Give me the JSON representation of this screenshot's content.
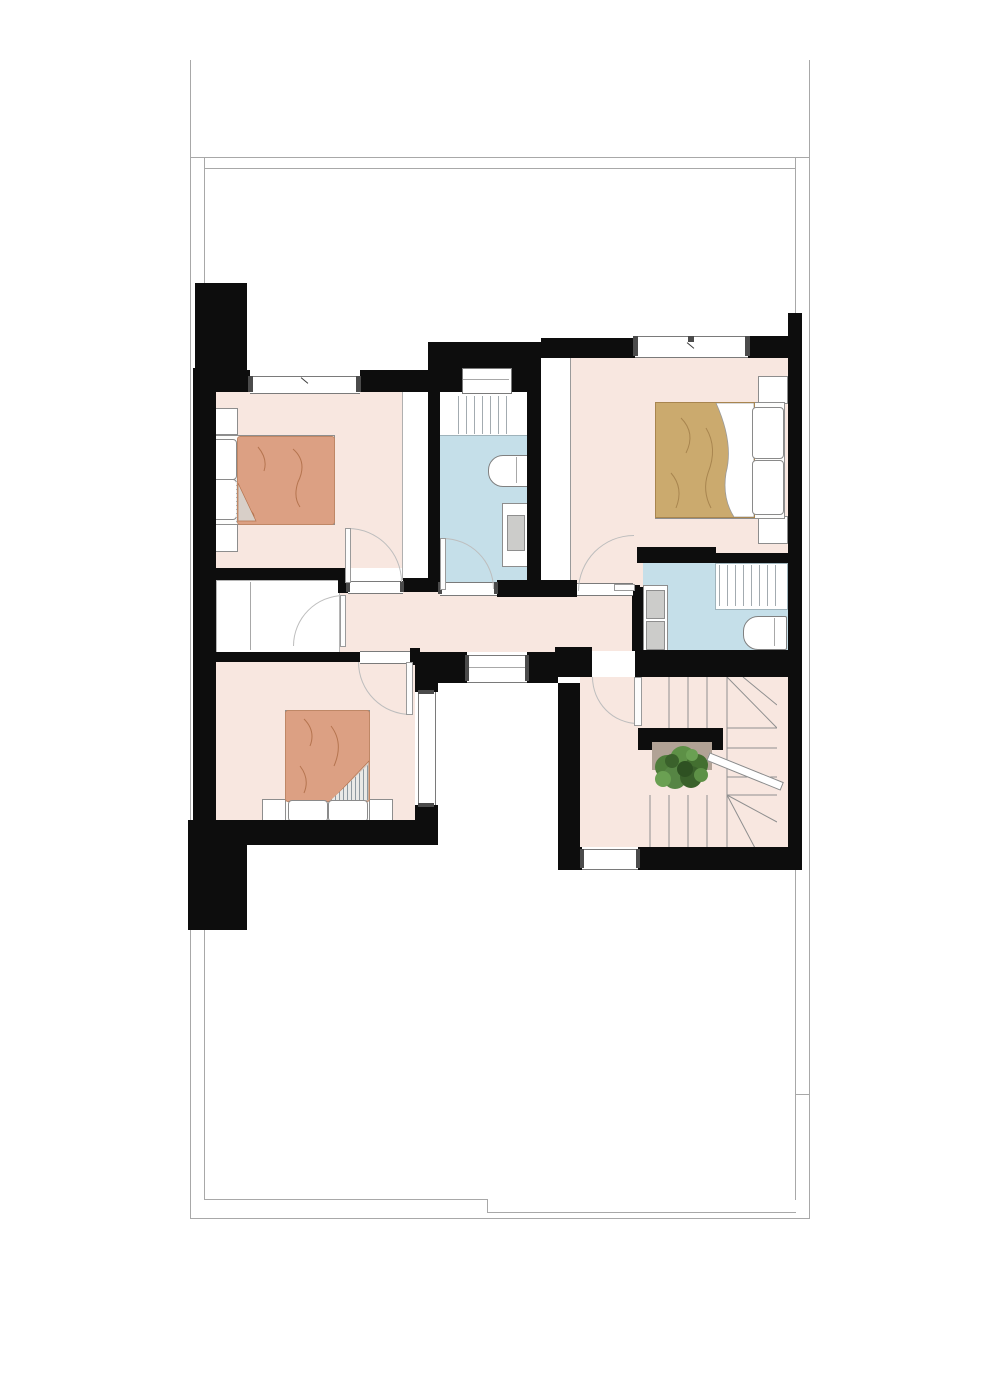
{
  "palette": {
    "wall": "#0d0d0d",
    "floor-pink": "#f8e7e0",
    "floor-blue": "#c5dfe9",
    "blanket-orange": "#dca083",
    "blanket-tan": "#cbaa6e",
    "line-gray": "#a8a8a8",
    "window-frame": "#7a7a7a",
    "window-cap": "#4b4b4b",
    "arc-gray": "#bdbdbd",
    "sink-gray": "#ccccca",
    "plant-green": "#4e7d3a",
    "landing-tan": "#b1a295"
  },
  "floor_plan": {
    "type": "residential-upper-floor",
    "visible_text": [],
    "rooms": [
      {
        "id": "bedroom-1",
        "position": "upper-left",
        "floor": "pink",
        "furniture": [
          "double-bed-orange-blanket",
          "nightstand",
          "nightstand"
        ],
        "windows": [
          "top-wall"
        ],
        "doors": [
          "to-corridor"
        ]
      },
      {
        "id": "bathroom-1",
        "position": "upper-center",
        "floor": "blue",
        "fixtures": [
          "shower",
          "toilet",
          "vanity-sink"
        ],
        "windows": [
          "top-wall-slot"
        ],
        "doors": [
          "to-corridor"
        ]
      },
      {
        "id": "bedroom-2",
        "position": "upper-right",
        "floor": "pink",
        "furniture": [
          "double-bed-tan-blanket",
          "nightstand",
          "nightstand",
          "wardrobe-strip"
        ],
        "windows": [
          "top-wall"
        ],
        "doors": [
          "to-corridor",
          "to-ensuite"
        ]
      },
      {
        "id": "ensuite-bathroom",
        "position": "middle-right",
        "floor": "blue",
        "fixtures": [
          "shower",
          "bathtub",
          "double-sink-vanity"
        ],
        "doors": [
          "open-from-bedroom-2"
        ]
      },
      {
        "id": "closet-room",
        "position": "middle-left",
        "floor": "white",
        "doors": [
          "to-corridor"
        ]
      },
      {
        "id": "corridor",
        "position": "center",
        "floor": "pink"
      },
      {
        "id": "bedroom-3",
        "position": "lower-left",
        "floor": "pink",
        "furniture": [
          "double-bed-orange-blanket",
          "nightstand",
          "nightstand"
        ],
        "windows": [
          "right-wall-to-lightwell"
        ],
        "doors": [
          "to-corridor"
        ]
      },
      {
        "id": "stair-hall",
        "position": "lower-right",
        "floor": "pink",
        "features": [
          "u-shaped-staircase-with-winders",
          "handrail",
          "potted-plant-on-landing"
        ],
        "windows": [
          "bottom-wall"
        ],
        "doors": [
          "to-corridor"
        ]
      },
      {
        "id": "lightwell-void",
        "position": "lower-center",
        "floor": "white"
      }
    ],
    "outline": {
      "description": "thin gray roof/terrace outline of lower level surrounding plan",
      "sides": [
        "left",
        "right",
        "top",
        "bottom"
      ]
    }
  }
}
